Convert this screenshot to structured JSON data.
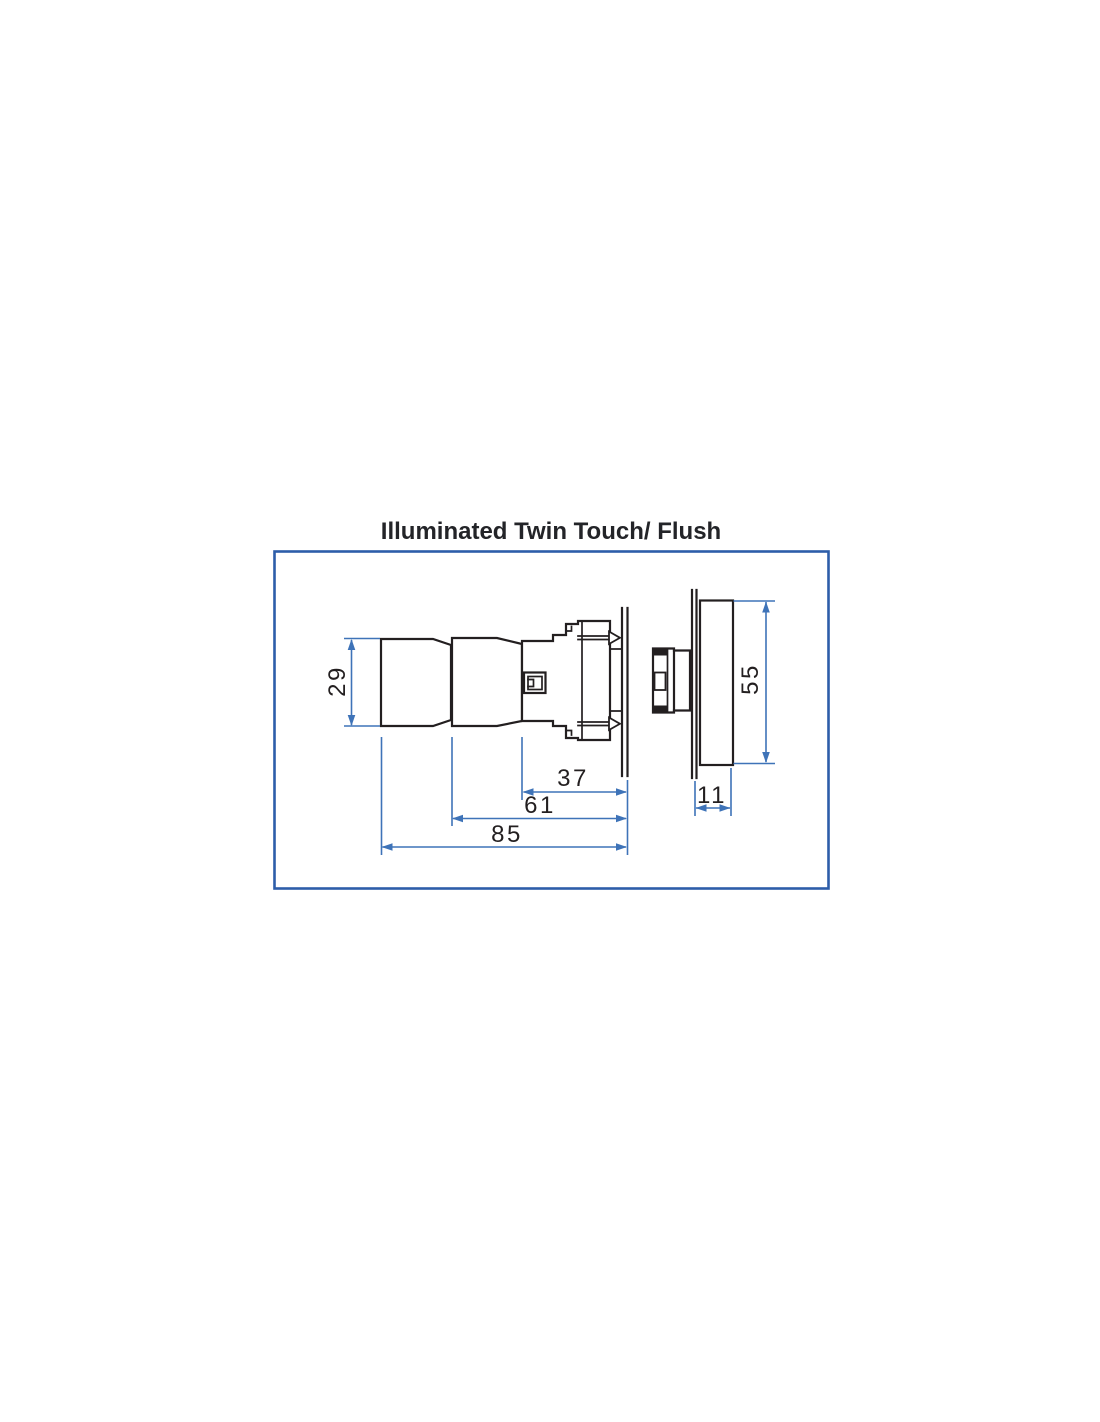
{
  "title": "Illuminated Twin Touch/ Flush",
  "dimensions": {
    "cap_height": "29",
    "bezel_height": "55",
    "front_body_depth": "37",
    "barrel_depth": "61",
    "overall_depth": "85",
    "bezel_depth": "11"
  },
  "colors": {
    "line": "#231f20",
    "dimension": "#3e73b8",
    "frame": "#2d5da9",
    "title_text": "#232428",
    "background": "#ffffff"
  }
}
